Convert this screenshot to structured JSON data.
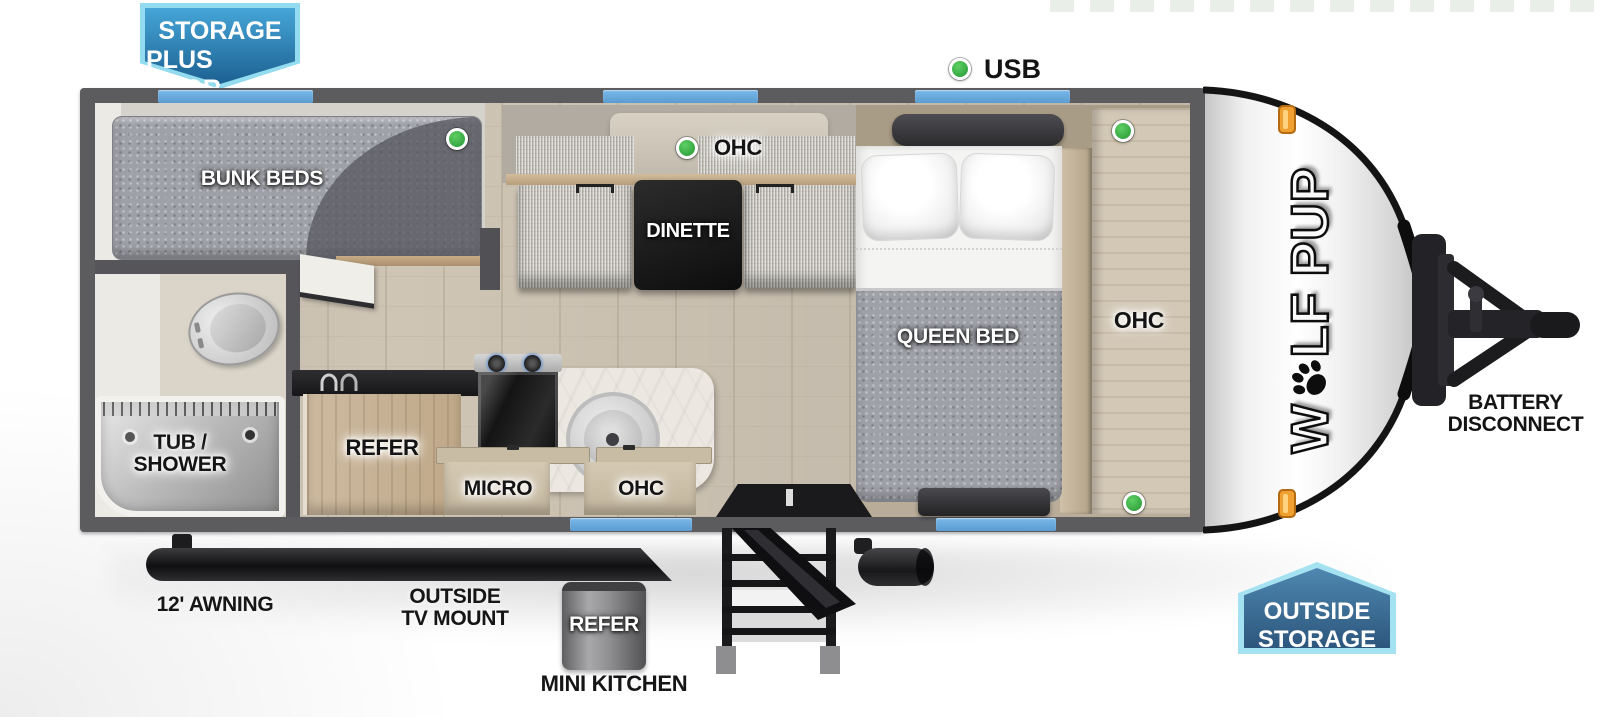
{
  "title": "Wolf Pup travel trailer floorplan",
  "badges": {
    "storage_plus_door": {
      "line1": "STORAGE",
      "line2": "PLUS DOOR"
    },
    "outside_storage": {
      "line1": "OUTSIDE",
      "line2": "STORAGE"
    }
  },
  "legend": {
    "usb_label": "USB"
  },
  "interior": {
    "bunk_beds": "BUNK BEDS",
    "dinette": "DINETTE",
    "dinette_ohc": "OHC",
    "shelf": "SHELF",
    "queen_bed": "QUEEN BED",
    "bedroom_ohc": "OHC",
    "tub_shower_line1": "TUB /",
    "tub_shower_line2": "SHOWER",
    "refer": "REFER",
    "micro": "MICRO",
    "kitchen_ohc": "OHC"
  },
  "exterior": {
    "awning": "12' AWNING",
    "tv_mount_line1": "OUTSIDE",
    "tv_mount_line2": "TV MOUNT",
    "mini_kitchen_refer": "REFER",
    "mini_kitchen": "MINI KITCHEN",
    "battery_line1": "BATTERY",
    "battery_line2": "DISCONNECT"
  },
  "brand": {
    "logo_prefix": "W",
    "logo_suffix": "LF PUP"
  },
  "colors": {
    "badge_blue_border": "#93dbee",
    "badge_blue_top": "#44a3d6",
    "badge_blue_bottom": "#1c6191",
    "window_blue": "#6aaade",
    "usb_green": "#3db24a",
    "marker_amber": "#f0a030",
    "wall_gray": "#5c5c5f"
  }
}
